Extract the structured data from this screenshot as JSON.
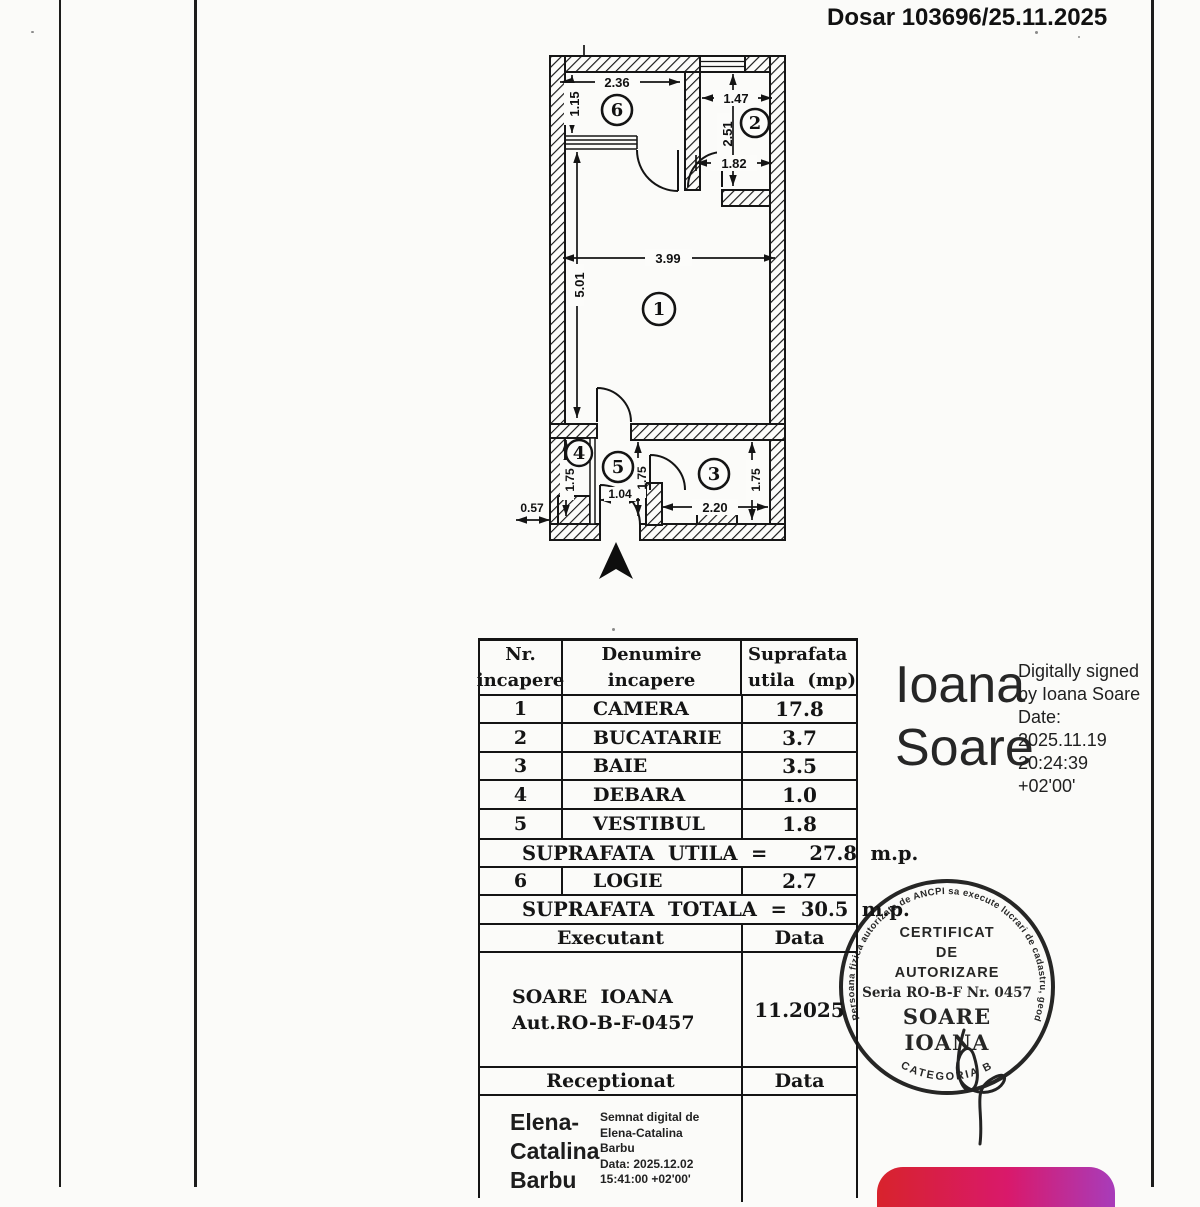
{
  "page": {
    "dosar_ref": "Dosar 103696/25.11.2025"
  },
  "plan": {
    "room_numbers": {
      "camera": "1",
      "bucatarie": "2",
      "baie": "3",
      "debara": "4",
      "vestibul": "5",
      "logie": "6"
    },
    "dims": {
      "logie_width": "2.36",
      "logie_depth": "1.15",
      "bucatarie_width": "1.47",
      "bucatarie_depth": "2.51",
      "bucatarie_inner": "1.82",
      "camera_width": "3.99",
      "camera_depth": "5.01",
      "debara_depth": "1.75",
      "vestibul_width": "1.04",
      "vestibul_depth": "1.75",
      "baie_width": "2.20",
      "baie_depth": "1.75",
      "niche_width": "0.57"
    }
  },
  "table": {
    "header": {
      "col1_line1": "Nr.",
      "col1_line2": "incapere",
      "col2_line1": "Denumire",
      "col2_line2": "incapere",
      "col3_line1": "Suprafata",
      "col3_line2": "utila  (mp)"
    },
    "rows": [
      {
        "nr": "1",
        "name": "CAMERA",
        "area": "17.8"
      },
      {
        "nr": "2",
        "name": "BUCATARIE",
        "area": "3.7"
      },
      {
        "nr": "3",
        "name": "BAIE",
        "area": "3.5"
      },
      {
        "nr": "4",
        "name": "DEBARA",
        "area": "1.0"
      },
      {
        "nr": "5",
        "name": "VESTIBUL",
        "area": "1.8"
      }
    ],
    "utila": {
      "label": "SUPRAFATA  UTILA  =",
      "value": "27.8  m.p."
    },
    "logie_row": {
      "nr": "6",
      "name": "LOGIE",
      "area": "2.7"
    },
    "totala": {
      "label": "SUPRAFATA  TOTALA  =",
      "value": "30.5  m.p."
    },
    "executant": {
      "label": "Executant",
      "data_label": "Data",
      "name": "SOARE  IOANA",
      "authorization": "Aut.RO-B-F-0457",
      "date": "11.2025"
    },
    "receptionat": {
      "label": "Receptionat",
      "data_label": "Data",
      "name_lines": [
        "Elena-",
        "Catalina",
        "Barbu"
      ],
      "signature_lines": [
        "Semnat digital de",
        "Elena-Catalina",
        "Barbu",
        "Data: 2025.12.02",
        "15:41:00 +02'00'"
      ]
    }
  },
  "digital_signature": {
    "name_line1": "Ioana",
    "name_line2": "Soare",
    "detail_lines": [
      "Digitally signed",
      "by Ioana Soare",
      "Date:",
      "2025.11.19",
      "20:24:39",
      "+02'00'"
    ]
  },
  "stamp": {
    "ring_text": "Persoana fizica autorizata de ANCPI sa execute lucrari de cadastru, geodezie si cartografie",
    "category": "CATEGORIA B",
    "center_lines": [
      "CERTIFICAT",
      "DE",
      "AUTORIZARE",
      "Seria RO-B-F Nr. 0457",
      "SOARE",
      "IOANA"
    ]
  },
  "logo_colors": {
    "start": "#d8232c",
    "mid": "#d9196b",
    "end": "#a83cba"
  }
}
